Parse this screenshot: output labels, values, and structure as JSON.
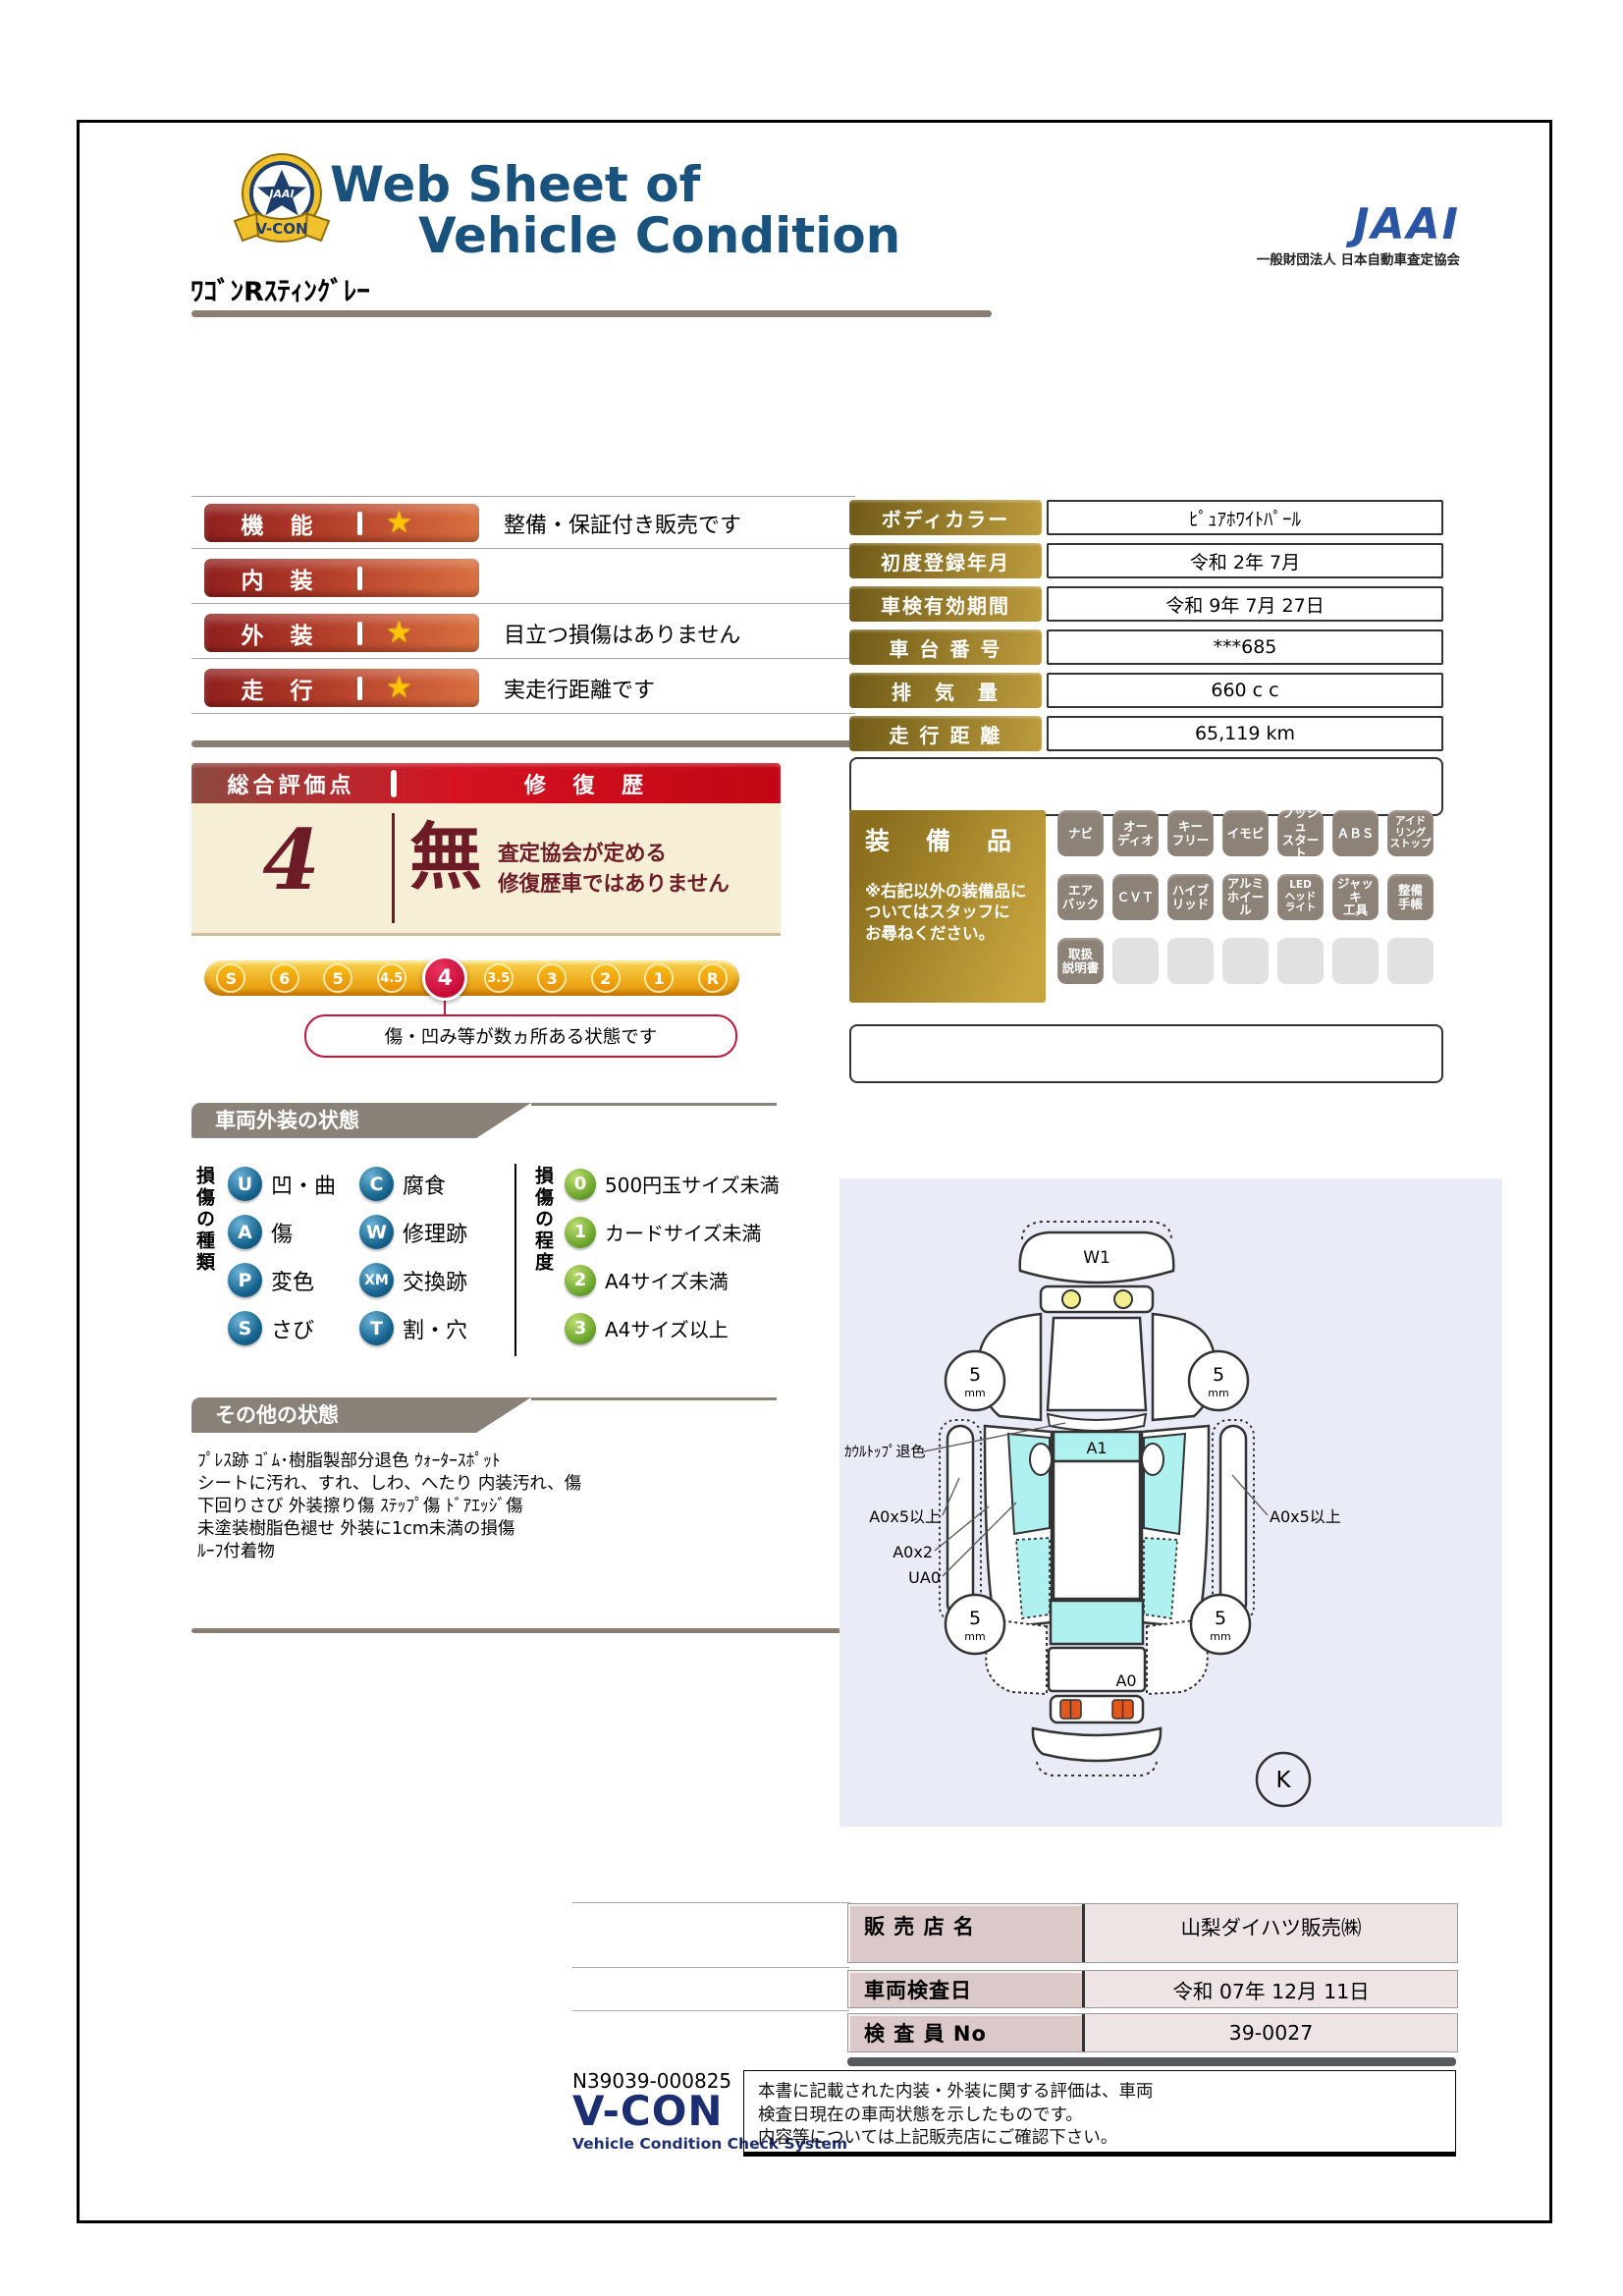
{
  "header": {
    "title_line1": "Web Sheet of",
    "title_line2": "Vehicle Condition",
    "jaai_logo": "JAAI",
    "jaai_subtitle": "一般財団法人 日本自動車査定協会",
    "emblem_ribbon": "V-CON",
    "emblem_star": "JAAI"
  },
  "vehicle_name": "ﾜｺﾞﾝRｽﾃｨﾝｸﾞﾚｰ",
  "icons": {
    "star": "★"
  },
  "ratings": [
    {
      "label": "機　能",
      "star": true,
      "note": "整備・保証付き販売です"
    },
    {
      "label": "内　装",
      "star": false,
      "note": ""
    },
    {
      "label": "外　装",
      "star": true,
      "note": "目立つ損傷はありません"
    },
    {
      "label": "走　行",
      "star": true,
      "note": "実走行距離です"
    }
  ],
  "overall": {
    "header_left": "総合評価点",
    "header_right": "修 復 歴",
    "score": "4",
    "repair_mark": "無",
    "repair_note1": "査定協会が定める",
    "repair_note2": "修復歴車ではありません",
    "scale": [
      "S",
      "6",
      "5",
      "4.5",
      "4",
      "3.5",
      "3",
      "2",
      "1",
      "R"
    ],
    "scale_active": "4",
    "callout": "傷・凹み等が数ヵ所ある状態です"
  },
  "vehicle_info": {
    "rows": [
      {
        "label": "ボディカラー",
        "value": "ﾋﾟｭｱﾎﾜｲﾄﾊﾟｰﾙ"
      },
      {
        "label": "初度登録年月",
        "value": "令和 2年 7月"
      },
      {
        "label": "車検有効期間",
        "value": "令和 9年 7月 27日"
      },
      {
        "label": "車 台 番 号",
        "value": "***685"
      },
      {
        "label": "排　気　量",
        "value": "660 c c"
      },
      {
        "label": "走 行 距 離",
        "value": "65,119 km"
      }
    ]
  },
  "equipment": {
    "title": "装　備　品",
    "note": "※右記以外の装備品に\nついてはスタッフに\nお尋ねください。",
    "badges": [
      "ナビ",
      "オー\nディオ",
      "キー\nフリー",
      "イモビ",
      "プッシュ\nスタート",
      "ＡＢＳ",
      "アイド\nリング\nストップ",
      "エア\nバック",
      "ＣＶＴ",
      "ハイブ\nリッド",
      "アルミ\nホイール",
      "LED\nヘッド\nライト",
      "ジャッキ\n工具",
      "整備\n手帳",
      "取扱\n説明書",
      "",
      "",
      "",
      "",
      "",
      ""
    ]
  },
  "exterior": {
    "title": "車両外装の状態",
    "kind_title": "損傷の種類",
    "kinds": [
      {
        "code": "U",
        "label": "凹・曲"
      },
      {
        "code": "A",
        "label": "傷"
      },
      {
        "code": "P",
        "label": "変色"
      },
      {
        "code": "S",
        "label": "さび"
      },
      {
        "code": "C",
        "label": "腐食"
      },
      {
        "code": "W",
        "label": "修理跡"
      },
      {
        "code": "XM",
        "label": "交換跡"
      },
      {
        "code": "T",
        "label": "割・穴"
      }
    ],
    "degree_title": "損傷の程度",
    "degrees": [
      {
        "code": "0",
        "label": "500円玉サイズ未満"
      },
      {
        "code": "1",
        "label": "カードサイズ未満"
      },
      {
        "code": "2",
        "label": "A4サイズ未満"
      },
      {
        "code": "3",
        "label": "A4サイズ以上"
      }
    ]
  },
  "other": {
    "title": "その他の状態",
    "lines": [
      "ﾌﾟﾚｽ跡 ｺﾞﾑ･樹脂製部分退色 ｳｫｰﾀｰｽﾎﾟｯﾄ",
      "シートに汚れ、すれ、しわ、へたり 内装汚れ、傷",
      "下回りさび 外装擦り傷 ｽﾃｯﾌﾟ傷 ﾄﾞｱｴｯｼﾞ傷",
      "未塗装樹脂色褪せ 外装に1cm未満の損傷",
      "ﾙｰﾌ付着物"
    ]
  },
  "diagram": {
    "front_panel": "W1",
    "roof_panel": "A1",
    "rear_panel": "A0",
    "cowl_note": "ｶｳﾙﾄｯﾌﾟ退色",
    "left_note1": "A0x5以上",
    "left_note2": "A0x2",
    "left_note3": "UA0",
    "right_note1": "A0x5以上",
    "wheel_value": "5",
    "wheel_unit": "mm",
    "k_mark": "K"
  },
  "dealer": {
    "rows": [
      {
        "label": "販 売 店 名",
        "value": "山梨ダイハツ販売㈱"
      },
      {
        "label": "車両検査日",
        "value": "令和 07年 12月 11日"
      },
      {
        "label": "検 査 員 No",
        "value": "39-0027"
      }
    ]
  },
  "footer": {
    "serial": "N39039-000825",
    "vcon": "V-CON",
    "vcon_sub": "Vehicle Condition Check System",
    "disclaimer": [
      "本書に記載された内装・外装に関する評価は、車両",
      "検査日現在の車両状態を示したものです。",
      "内容等については上記販売店にご確認下さい。"
    ]
  },
  "colors": {
    "title_navy": "#19527d",
    "jaai_blue": "#2a55a4",
    "bar_red_dark": "#8f1f1e",
    "bar_orange": "#d96f3f",
    "overall_red": "#d41222",
    "cream": "#f6efd6",
    "maroon_text": "#6d1b26",
    "gold_dark": "#6f5a17",
    "gold_light": "#bd9c3e",
    "badge_gray": "#8d8277",
    "section_gray": "#8a8179",
    "scale_gold": "#eca517",
    "scale_active_red": "#c60a38",
    "legend_blue": "#16648f",
    "legend_green": "#6fa82f",
    "diagram_bg": "#e9ebf7",
    "damage_cyan": "#aef1ee",
    "dealer_label_pink": "#dbc8c8",
    "dealer_value_pink": "#efe4e4",
    "vcon_navy": "#1c2e72"
  }
}
